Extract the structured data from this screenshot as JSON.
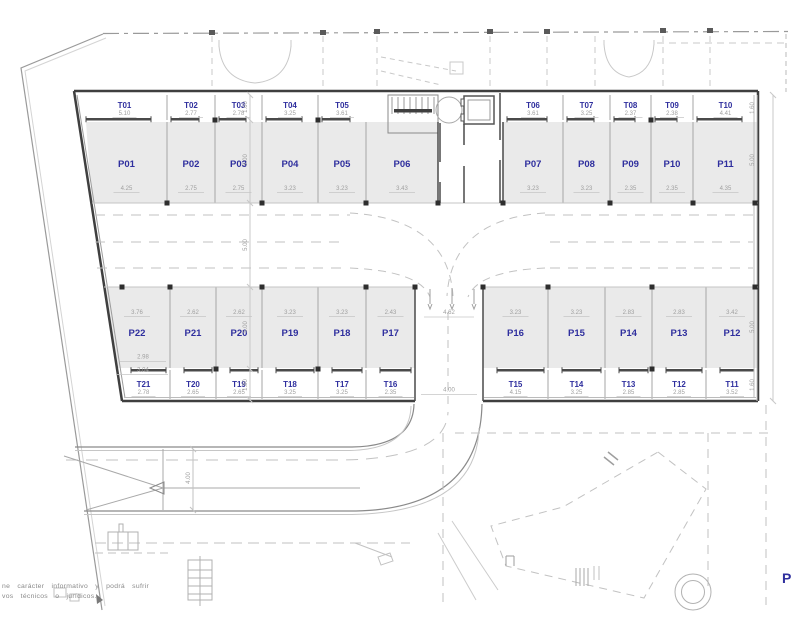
{
  "meta": {
    "disclaimer_line1": "ne carácter informativo y podrá sufrir",
    "disclaimer_line2": "vos técnicos o jurídicos.",
    "corner_letter": "P"
  },
  "colors": {
    "label": "#2f2f9e",
    "dim": "#9f9f9f",
    "stall_fill": "#eaeaea",
    "wall": "#3f3f3f"
  },
  "wings": {
    "top_left": {
      "t": [
        {
          "id": "T01",
          "dim": "5.10"
        },
        {
          "id": "T02",
          "dim": "2.77"
        },
        {
          "id": "T03",
          "dim": "2.78"
        },
        {
          "id": "T04",
          "dim": "3.25"
        },
        {
          "id": "T05",
          "dim": "3.61"
        }
      ],
      "p": [
        {
          "id": "P01",
          "dim": "4.25"
        },
        {
          "id": "P02",
          "dim": "2.75"
        },
        {
          "id": "P03",
          "dim": "2.75"
        },
        {
          "id": "P04",
          "dim": "3.23"
        },
        {
          "id": "P05",
          "dim": "3.23"
        },
        {
          "id": "P06",
          "dim": "3.43"
        }
      ]
    },
    "top_right": {
      "t": [
        {
          "id": "T06",
          "dim": "3.61"
        },
        {
          "id": "T07",
          "dim": "3.25"
        },
        {
          "id": "T08",
          "dim": "2.37"
        },
        {
          "id": "T09",
          "dim": "2.38"
        },
        {
          "id": "T10",
          "dim": "4.41"
        }
      ],
      "p": [
        {
          "id": "P07",
          "dim": "3.23"
        },
        {
          "id": "P08",
          "dim": "3.23"
        },
        {
          "id": "P09",
          "dim": "2.35"
        },
        {
          "id": "P10",
          "dim": "2.35"
        },
        {
          "id": "P11",
          "dim": "4.35"
        }
      ]
    },
    "bottom_left": {
      "p": [
        {
          "id": "P22",
          "dim": "3.76"
        },
        {
          "id": "P21",
          "dim": "2.62"
        },
        {
          "id": "P20",
          "dim": "2.62"
        },
        {
          "id": "P19",
          "dim": "3.23"
        },
        {
          "id": "P18",
          "dim": "3.23"
        },
        {
          "id": "P17",
          "dim": "2.43"
        }
      ],
      "t": [
        {
          "id": "T21",
          "dim": "2.78"
        },
        {
          "id": "T20",
          "dim": "2.65"
        },
        {
          "id": "T19",
          "dim": "2.65"
        },
        {
          "id": "T18",
          "dim": "3.25"
        },
        {
          "id": "T17",
          "dim": "3.25"
        },
        {
          "id": "T16",
          "dim": "2.35"
        }
      ]
    },
    "bottom_right": {
      "p": [
        {
          "id": "P16",
          "dim": "3.23"
        },
        {
          "id": "P15",
          "dim": "3.23"
        },
        {
          "id": "P14",
          "dim": "2.83"
        },
        {
          "id": "P13",
          "dim": "2.83"
        },
        {
          "id": "P12",
          "dim": "3.42"
        }
      ],
      "t": [
        {
          "id": "T15",
          "dim": "4.15"
        },
        {
          "id": "T14",
          "dim": "3.25"
        },
        {
          "id": "T13",
          "dim": "2.85"
        },
        {
          "id": "T12",
          "dim": "2.85"
        },
        {
          "id": "T11",
          "dim": "3.52"
        }
      ]
    }
  },
  "dims": {
    "center_line": [
      "1.60",
      "5.00",
      "5.00",
      "5.00",
      "1.80"
    ],
    "right_line": [
      "1.60",
      "5.00",
      "5.00",
      "1.60"
    ],
    "lane_top": "4.62",
    "lane_bottom": "4.00",
    "road_width": "4.00",
    "p22_inner": [
      "2.98",
      "3.04"
    ]
  }
}
